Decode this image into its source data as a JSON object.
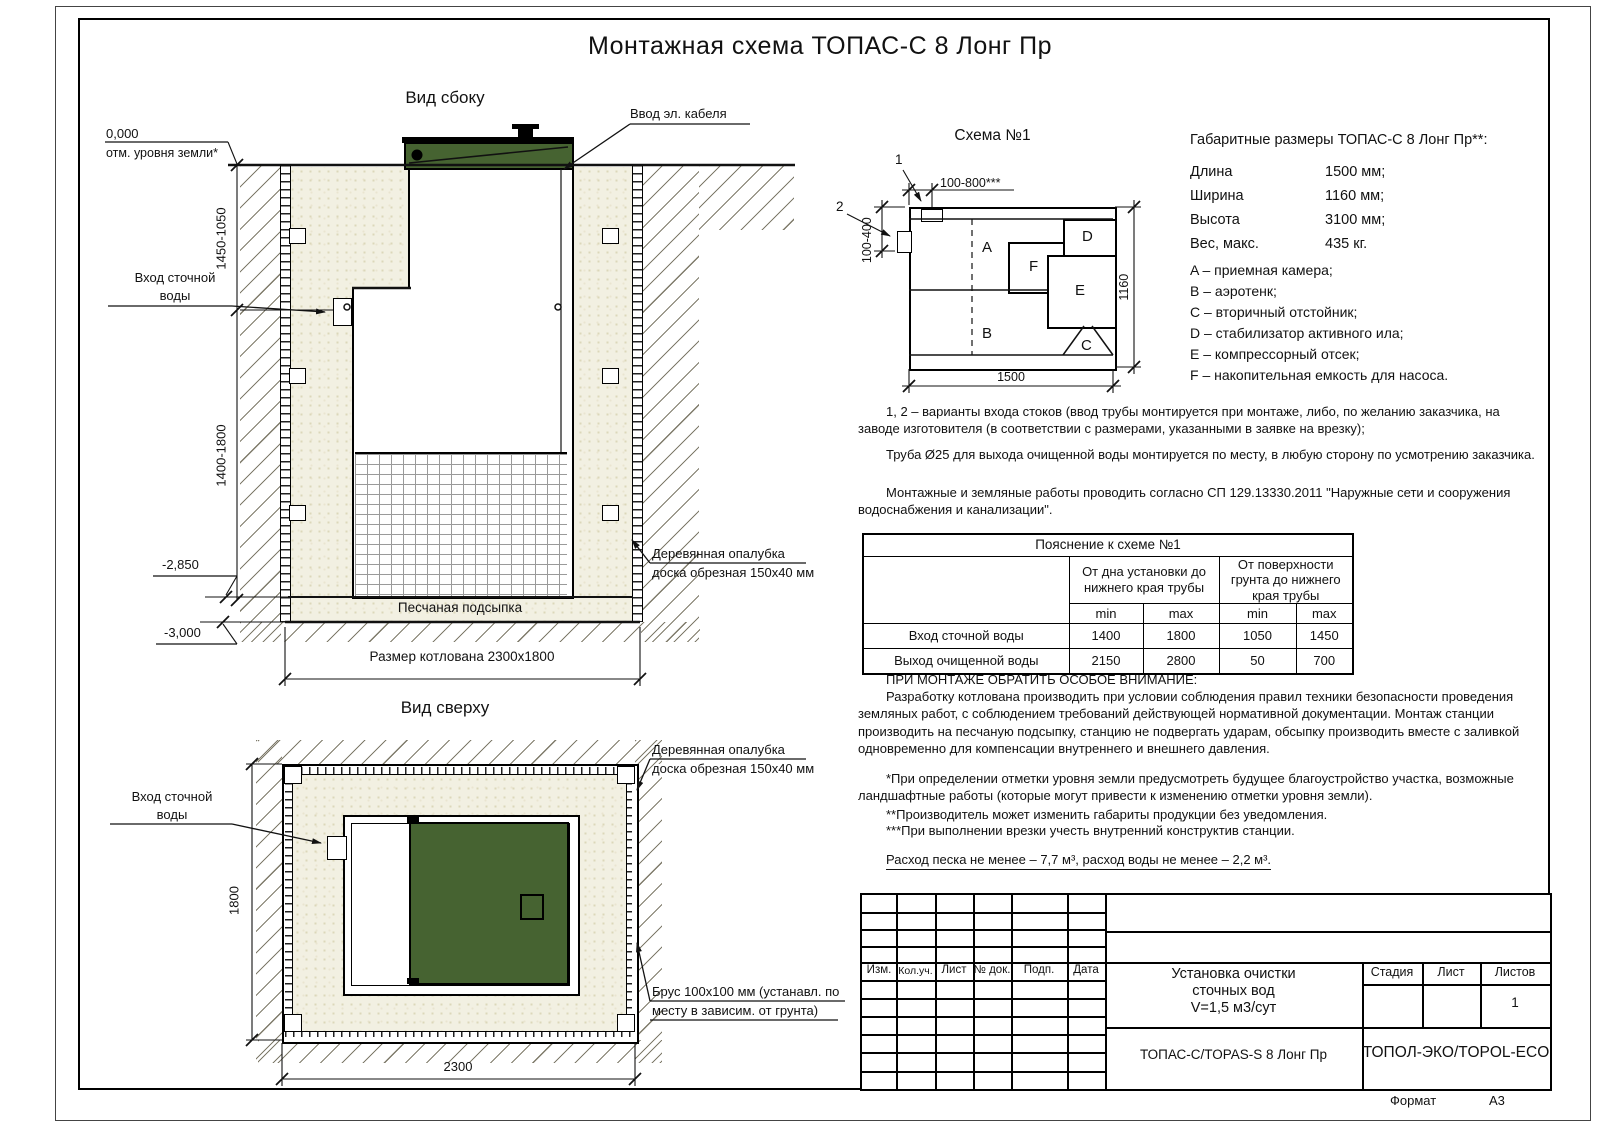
{
  "page": {
    "main_title": "Монтажная схема ТОПАС-С 8 Лонг Пр"
  },
  "colors": {
    "lid_green": "#466331",
    "sand": "#f2f0e2",
    "line": "#111111"
  },
  "side_view": {
    "title": "Вид сбоку",
    "cable_label": "Ввод эл. кабеля",
    "zero_mark": "0,000",
    "zero_sub": "отм. уровня земли*",
    "dim_upper": "1450-1050",
    "inlet_line1": "Вход сточной",
    "inlet_line2": "воды",
    "dim_lower": "1400-1800",
    "level_mid": "-2,850",
    "level_bottom": "-3,000",
    "formwork_line1": "Деревянная опалубка",
    "formwork_line2": "доска обрезная 150х40 мм",
    "bedding_label": "Песчаная подсыпка",
    "pit_dim": "Размер котлована 2300х1800"
  },
  "top_view": {
    "title": "Вид сверху",
    "dim_height": "1800",
    "dim_width": "2300",
    "inlet_line1": "Вход сточной",
    "inlet_line2": "воды",
    "formwork_line1": "Деревянная опалубка",
    "formwork_line2": "доска обрезная 150х40 мм",
    "beam_line1": "Брус 100х100 мм (устанавл. по",
    "beam_line2": "месту в зависим. от грунта)"
  },
  "schema": {
    "title": "Схема №1",
    "marker1": "1",
    "marker2": "2",
    "dim_inlet_top": "100-800***",
    "dim_inlet_side": "100-400",
    "dim_width": "1500",
    "dim_height": "1160",
    "chambers": {
      "a": "A",
      "b": "B",
      "c": "C",
      "d": "D",
      "e": "E",
      "f": "F"
    }
  },
  "specs": {
    "title": "Габаритные размеры ТОПАС-С 8 Лонг Пр**:",
    "rows": [
      {
        "label": "Длина",
        "value": "1500 мм;"
      },
      {
        "label": "Ширина",
        "value": "1160 мм;"
      },
      {
        "label": "Высота",
        "value": "3100 мм;"
      },
      {
        "label": "Вес, макс.",
        "value": "435 кг."
      }
    ],
    "legend": [
      "A – приемная камера;",
      "B – аэротенк;",
      "C – вторичный отстойник;",
      "D – стабилизатор активного ила;",
      "E – компрессорный отсек;",
      "F – накопительная емкость для насоса."
    ]
  },
  "notes": {
    "note1": "1, 2 – варианты входа  стоков (ввод трубы монтируется при монтаже, либо, по желанию заказчика, на заводе изготовителя (в соответствии с размерами, указанными в заявке на врезку);",
    "note2": "Труба Ø25 для выхода очищенной воды монтируется по месту, в любую сторону по усмотрению заказчика.",
    "note3": "Монтажные и земляные работы проводить согласно СП 129.13330.2011 \"Наружные сети и сооружения водоснабжения и канализации\"."
  },
  "table": {
    "title": "Пояснение к схеме №1",
    "group1": "От дна установки до нижнего края трубы",
    "group2": "От поверхности грунта до нижнего края трубы",
    "min": "min",
    "max": "max",
    "rows": [
      {
        "label": "Вход сточной воды",
        "v": [
          "1400",
          "1800",
          "1050",
          "1450"
        ]
      },
      {
        "label": "Выход очищенной воды",
        "v": [
          "2150",
          "2800",
          "50",
          "700"
        ]
      }
    ]
  },
  "attention": {
    "title": "ПРИ МОНТАЖЕ ОБРАТИТЬ ОСОБОЕ ВНИМАНИЕ:",
    "body": "Разработку котлована производить при условии соблюдения правил техники безопасности проведения земляных работ, с соблюдением требований действующей нормативной документации. Монтаж станции производить на песчаную подсыпку, станцию не подвергать ударам, обсыпку производить вместе с заливкой одновременно для компенсации внутреннего и внешнего давления.",
    "fn1": "*При определении отметки уровня земли предусмотреть будущее благоустройство участка, возможные ландшафтные работы (которые могут привести к изменению отметки уровня земли).",
    "fn2": "**Производитель может изменить габариты продукции без уведомления.",
    "fn3": "***При выполнении врезки учесть внутренний конструктив станции."
  },
  "consumption": "Расход песка не менее – 7,7 м³, расход воды не менее – 2,2 м³.",
  "stamp": {
    "cols": [
      "Изм.",
      "Кол.уч.",
      "Лист",
      "№ док.",
      "Подп.",
      "Дата"
    ],
    "project_line1": "Установка очистки",
    "project_line2": "сточных вод",
    "project_line3": "V=1,5 м3/сут",
    "stage_label": "Стадия",
    "sheet_label": "Лист",
    "sheets_label": "Листов",
    "sheets_value": "1",
    "doc_name": "ТОПАС-С/TOPAS-S 8 Лонг Пр",
    "company": "ТОПОЛ-ЭКО/TOPOL-ECO"
  },
  "format": {
    "label": "Формат",
    "value": "А3"
  }
}
